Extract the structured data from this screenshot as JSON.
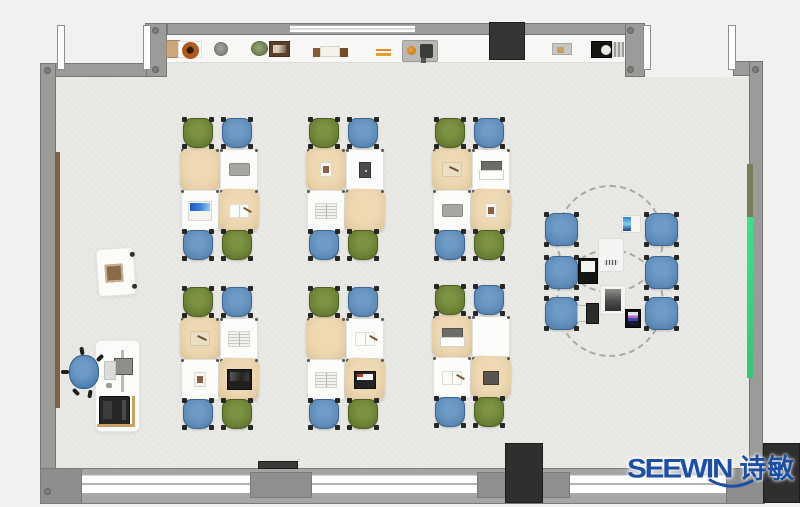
{
  "logo": {
    "latin": "SEEWIN",
    "cjk": "诗敏",
    "color": "#1c4fa4"
  },
  "palette": {
    "outside": "#f1f1ef",
    "floor": "#e9e9e6",
    "wall": "#9b9b99",
    "counter": "#f7f7f5",
    "dark_block": "#2f2f2d",
    "chair_green": "#6b8034",
    "chair_blue": "#5e8db9",
    "desk_white": "#fcfcfa",
    "desk_cover_tan": "#e7d2ab",
    "board_green_strip": "#2ed47b",
    "rail_wood": "#7e6244",
    "logo_blue": "#1c4fa4"
  },
  "furniture": {
    "desk_clusters": [
      {
        "id": "row1-col1",
        "x": 181,
        "y": 118,
        "desk_items": [
          "none",
          "laptop-gray",
          "laptop-open",
          "notebook-open"
        ]
      },
      {
        "id": "row1-col2",
        "x": 307,
        "y": 118,
        "desk_items": [
          "photo-card",
          "tablet-dark",
          "book-open",
          "none"
        ]
      },
      {
        "id": "row1-col3",
        "x": 433,
        "y": 118,
        "desk_items": [
          "notebook-tan",
          "keyboard-white",
          "laptop-gray",
          "photo-card"
        ]
      },
      {
        "id": "row2-col1",
        "x": 181,
        "y": 287,
        "desk_items": [
          "notebook-tan",
          "book-open",
          "photo-card",
          "laptop-black-open"
        ]
      },
      {
        "id": "row2-col2",
        "x": 307,
        "y": 287,
        "desk_items": [
          "none",
          "notebook-open",
          "book-open",
          "laptop-black-red"
        ]
      },
      {
        "id": "row2-col3",
        "x": 433,
        "y": 285,
        "desk_items": [
          "keyboard-white",
          "none",
          "notebook-open",
          "book-dark"
        ]
      }
    ],
    "cluster_chair_colors": [
      "green",
      "blue",
      "blue",
      "green"
    ],
    "collab_area": {
      "chairs": [
        {
          "x": 545,
          "y": 213
        },
        {
          "x": 645,
          "y": 213
        },
        {
          "x": 545,
          "y": 256
        },
        {
          "x": 645,
          "y": 256
        },
        {
          "x": 545,
          "y": 297
        },
        {
          "x": 645,
          "y": 297
        }
      ],
      "devices": [
        {
          "type": "tablet-blue",
          "x": 621,
          "y": 215,
          "w": 20,
          "h": 18
        },
        {
          "type": "pad-laptop-dark",
          "x": 598,
          "y": 238,
          "w": 26,
          "h": 34
        },
        {
          "type": "laptop-black-open2",
          "x": 578,
          "y": 258,
          "w": 20,
          "h": 26
        },
        {
          "type": "pad-laptop-gray",
          "x": 600,
          "y": 285,
          "w": 26,
          "h": 30
        },
        {
          "type": "laptop-small",
          "x": 577,
          "y": 303,
          "w": 22,
          "h": 21
        },
        {
          "type": "phone-colorful",
          "x": 625,
          "y": 309,
          "w": 16,
          "h": 19
        }
      ],
      "dashed_tables": [
        {
          "cx": 608,
          "cy": 237,
          "r": 52
        },
        {
          "cx": 608,
          "cy": 301,
          "r": 52
        }
      ]
    },
    "counter_items": [
      {
        "type": "cabinet",
        "x": 166,
        "y": 40,
        "w": 14,
        "h": 18
      },
      {
        "type": "pot",
        "x": 178,
        "y": 41,
        "w": 24,
        "h": 17
      },
      {
        "type": "stone",
        "x": 214,
        "y": 42,
        "w": 14,
        "h": 14
      },
      {
        "type": "plant",
        "x": 251,
        "y": 41,
        "w": 17,
        "h": 15
      },
      {
        "type": "frame",
        "x": 269,
        "y": 41,
        "w": 21,
        "h": 16
      },
      {
        "type": "books",
        "x": 320,
        "y": 46,
        "w": 20,
        "h": 11
      },
      {
        "type": "pens",
        "x": 376,
        "y": 49,
        "w": 15,
        "h": 7
      },
      {
        "type": "tray",
        "x": 402,
        "y": 40,
        "w": 36,
        "h": 22
      },
      {
        "type": "tray-small",
        "x": 552,
        "y": 43,
        "w": 20,
        "h": 12
      },
      {
        "type": "device",
        "x": 591,
        "y": 41,
        "w": 21,
        "h": 17
      }
    ]
  }
}
